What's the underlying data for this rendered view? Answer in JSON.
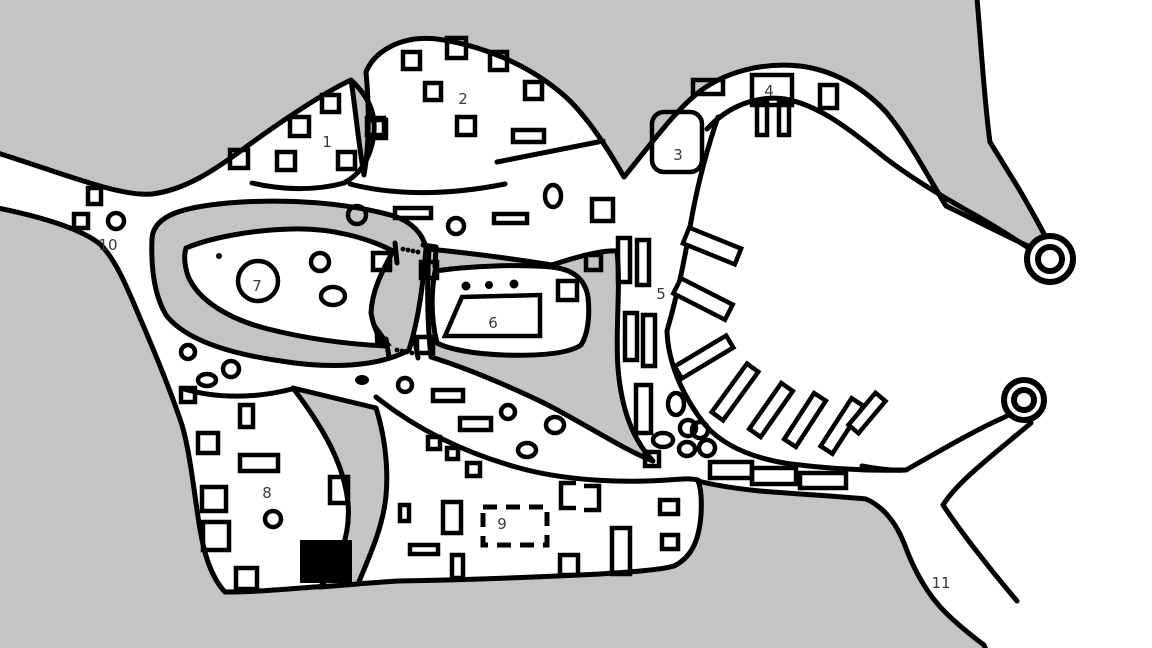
{
  "map": {
    "colors": {
      "sea": "#c4c4c4",
      "land": "#ffffff",
      "outline": "#000000",
      "label": "#3a3a3a"
    },
    "regions": [
      {
        "id": 1,
        "label": "1"
      },
      {
        "id": 2,
        "label": "2"
      },
      {
        "id": 3,
        "label": "3"
      },
      {
        "id": 4,
        "label": "4"
      },
      {
        "id": 5,
        "label": "5"
      },
      {
        "id": 6,
        "label": "6"
      },
      {
        "id": 7,
        "label": "7"
      },
      {
        "id": 8,
        "label": "8"
      },
      {
        "id": 9,
        "label": "9"
      },
      {
        "id": 10,
        "label": "10"
      },
      {
        "id": 11,
        "label": "11"
      }
    ],
    "features": {
      "roundabout_count": 2,
      "ferry_route_count": 2,
      "pier_count": 8,
      "icons": [
        "building-outline-icon",
        "building-solid-icon",
        "boat-icon",
        "pier-icon",
        "dock-icon",
        "roundabout-icon",
        "ferry-route-dotted-icon",
        "island-icon",
        "lagoon-icon"
      ]
    }
  }
}
